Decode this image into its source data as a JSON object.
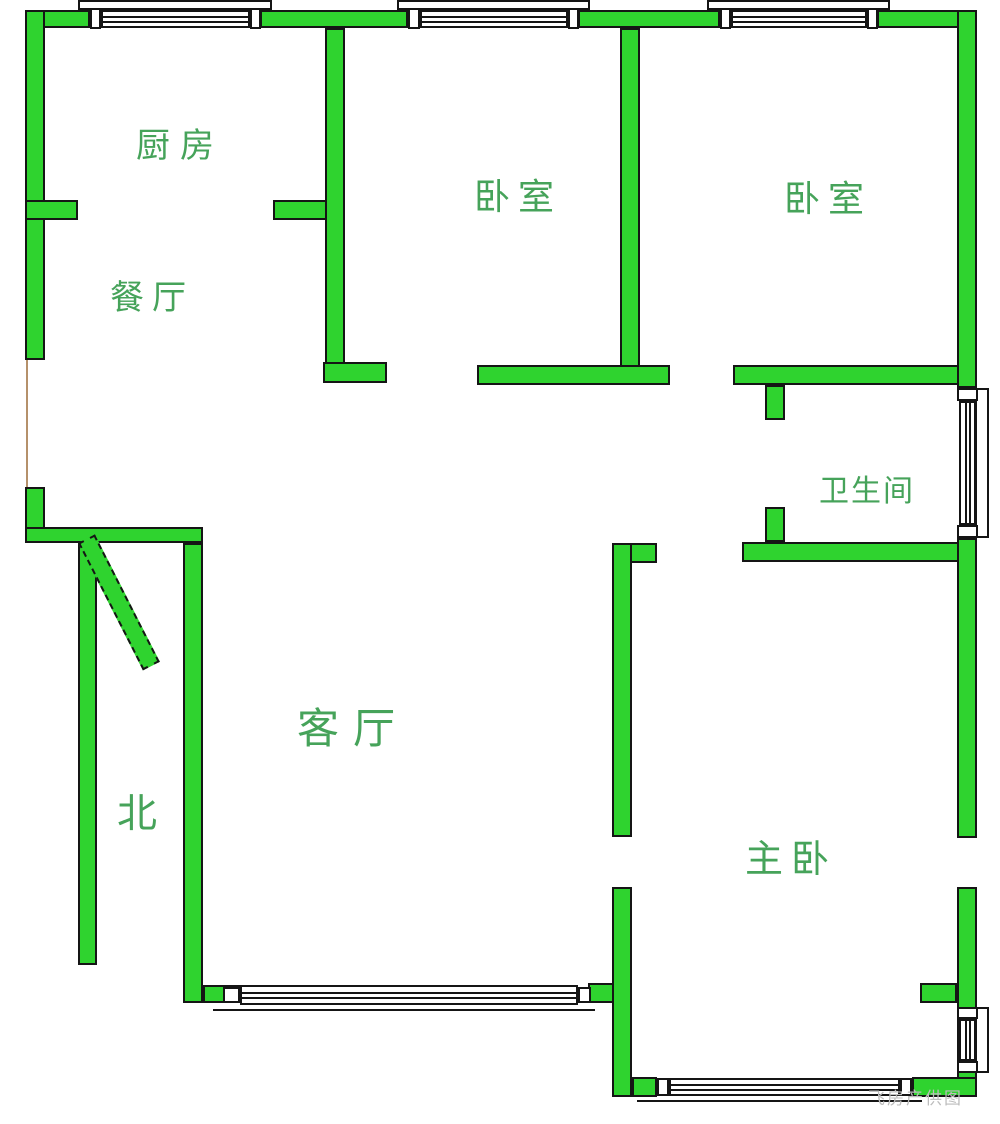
{
  "plan": {
    "rooms": {
      "kitchen": {
        "label": "厨房"
      },
      "dining": {
        "label": "餐厅"
      },
      "bedroom1": {
        "label": "卧室"
      },
      "bedroom2": {
        "label": "卧室"
      },
      "bathroom": {
        "label": "卫生间"
      },
      "living": {
        "label": "客厅"
      },
      "master": {
        "label": "主卧"
      }
    },
    "compass": {
      "north": "北"
    },
    "watermark": {
      "credit": "飞房产供图"
    },
    "colors": {
      "wall_fill": "#2fd32f",
      "wall_outline": "#151515",
      "label": "#46a35a",
      "open_edge_line": "#b5916b",
      "watermark": "#bcbcbc",
      "background": "#ffffff"
    }
  }
}
